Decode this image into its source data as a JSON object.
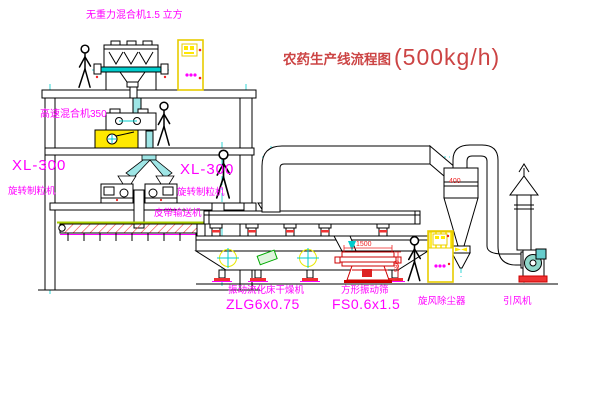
{
  "title": {
    "text": "农药生产线流程图",
    "capacity": "(500kg/h)"
  },
  "labels": {
    "gravity_mixer": "无重力混合机1.5 立方",
    "high_speed_mixer": "高速混合机350",
    "granulator_left": {
      "model": "XL-300",
      "name": "旋转制粒机"
    },
    "granulator_right": {
      "model": "XL-300",
      "name": "旋转制粒机"
    },
    "belt_conveyor": "皮带输送机",
    "fluid_bed_dryer": {
      "name": "振动流化床干燥机",
      "model": "ZLG6x0.75"
    },
    "square_sieve": {
      "name": "方形振动筛",
      "model": "FS0.6x1.5"
    },
    "cyclone": "旋风除尘器",
    "induced_draft_fan": "引风机"
  },
  "dimensions": {
    "cyclone": "400",
    "sieve_width": "1500",
    "sieve_height": "580"
  },
  "colors": {
    "background": "#ffffff",
    "line_black": "#000000",
    "centerline_cyan": "#00cccc",
    "label_magenta": "#ff00ff",
    "title_red": "#cc4444",
    "dim_red": "#ee2222",
    "cabinet_yellow": "#e8cc00",
    "machine_yellow": "#ffe800",
    "pipe_cyan": "#9fe6e6",
    "foot_red": "#ee3333",
    "conveyor_green": "#aacc00"
  }
}
